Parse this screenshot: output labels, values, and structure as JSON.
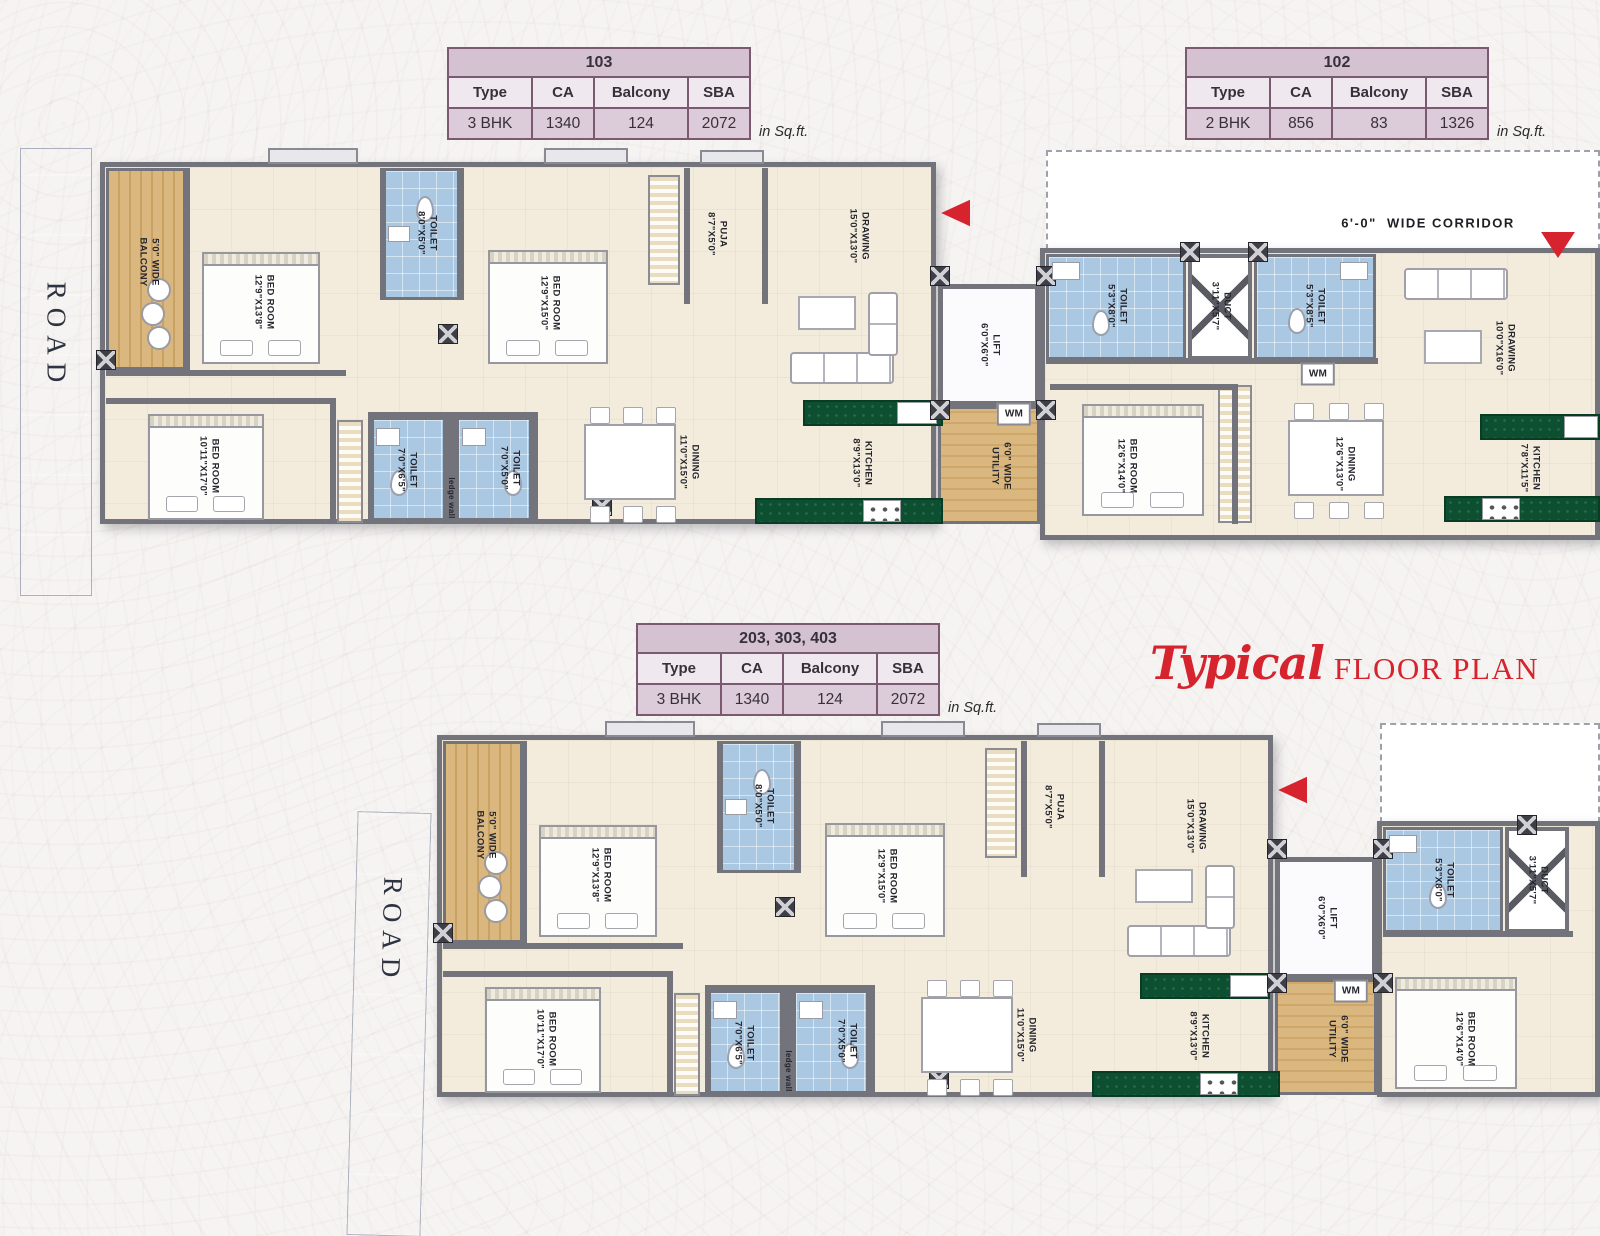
{
  "title": {
    "script": "Typical",
    "text": "FLOOR PLAN"
  },
  "roads": [
    "ROAD",
    "ROAD"
  ],
  "tables": [
    {
      "unit": "103",
      "col_headers": [
        "Type",
        "CA",
        "Balcony",
        "SBA"
      ],
      "row": [
        "3 BHK",
        "1340",
        "124",
        "2072"
      ],
      "note": "in Sq.ft."
    },
    {
      "unit": "102",
      "col_headers": [
        "Type",
        "CA",
        "Balcony",
        "SBA"
      ],
      "row": [
        "2 BHK",
        "856",
        "83",
        "1326"
      ],
      "note": "in Sq.ft."
    },
    {
      "unit": "203, 303, 403",
      "col_headers": [
        "Type",
        "CA",
        "Balcony",
        "SBA"
      ],
      "row": [
        "3 BHK",
        "1340",
        "124",
        "2072"
      ],
      "note": "in Sq.ft."
    }
  ],
  "colors": {
    "accent_red": "#d7232e",
    "table_border": "#7b5a71",
    "table_header_bg": "#d5c2d1",
    "table_subheader_bg": "#efe8ee",
    "table_value_bg": "#dccbd8",
    "road": "#c7cdd9",
    "toilet_blue": "#abc8e3",
    "wood": "#d7b27c",
    "counter_green": "#0c4f31",
    "floor_cream": "#f3ecdc",
    "wall_gray": "#73737c"
  },
  "plans": [
    {
      "labels": [
        {
          "text": "5'0\" WIDE\nBALCONY",
          "x": 148,
          "y": 262,
          "r": 90
        },
        {
          "text": "BED ROOM\n12'9\"X13'8\"",
          "x": 263,
          "y": 302,
          "r": 90
        },
        {
          "text": "TOILET\n8'0\"X5'0\"",
          "x": 426,
          "y": 233,
          "r": 90
        },
        {
          "text": "BED ROOM\n12'9\"X15'0\"",
          "x": 549,
          "y": 303,
          "r": 90
        },
        {
          "text": "PUJA\n8'7\"X5'0\"",
          "x": 716,
          "y": 234,
          "r": 90
        },
        {
          "text": "DRAWING\n15'0\"X13'0\"",
          "x": 858,
          "y": 236,
          "r": 90
        },
        {
          "text": "LIFT\n6'0\"X6'0\"",
          "x": 989,
          "y": 345,
          "r": 90
        },
        {
          "text": "BED ROOM\n10'11\"X17'0\"",
          "x": 208,
          "y": 466,
          "r": 90
        },
        {
          "text": "TOILET\n7'0\"X6'5\"",
          "x": 406,
          "y": 470,
          "r": 90
        },
        {
          "text": "ledge wall",
          "x": 451,
          "y": 498,
          "r": 90,
          "cls": "small"
        },
        {
          "text": "TOILET\n7'0\"X5'0\"",
          "x": 509,
          "y": 468,
          "r": 90
        },
        {
          "text": "DINING\n11'0\"X15'0\"",
          "x": 688,
          "y": 462,
          "r": 90
        },
        {
          "text": "KITCHEN\n8'9\"X13'0\"",
          "x": 861,
          "y": 463,
          "r": 90
        },
        {
          "text": "6'0\" WIDE\nUTILITY",
          "x": 1000,
          "y": 466,
          "r": 90
        },
        {
          "text": "WM",
          "x": 1014,
          "y": 414,
          "r": 0,
          "cls": "boxed"
        },
        {
          "text": "TOILET\n5'3\"X8'0\"",
          "x": 1116,
          "y": 306,
          "r": 90
        },
        {
          "text": "DUCT\n3'11\"X5'7\"",
          "x": 1220,
          "y": 306,
          "r": 90
        },
        {
          "text": "TOILET\n5'3\"X8'5\"",
          "x": 1314,
          "y": 306,
          "r": 90
        },
        {
          "text": "WM",
          "x": 1318,
          "y": 374,
          "r": 0,
          "cls": "boxed"
        },
        {
          "text": "DRAWING\n10'0\"X16'0\"",
          "x": 1504,
          "y": 348,
          "r": 90
        },
        {
          "text": "BED ROOM\n12'6\"X14'0\"",
          "x": 1126,
          "y": 466,
          "r": 90
        },
        {
          "text": "DINING\n12'6\"X13'0\"",
          "x": 1344,
          "y": 464,
          "r": 90
        },
        {
          "text": "KITCHEN\n7'8\"X11'5\"",
          "x": 1529,
          "y": 468,
          "r": 90
        },
        {
          "text": "6'-0\"  WIDE CORRIDOR",
          "x": 1428,
          "y": 224,
          "r": 0,
          "cls": "corridor"
        }
      ]
    },
    {
      "labels": [
        {
          "text": "5'0\" WIDE\nBALCONY",
          "x": 485,
          "y": 835,
          "r": 90
        },
        {
          "text": "BED ROOM\n12'9\"X13'8\"",
          "x": 600,
          "y": 875,
          "r": 90
        },
        {
          "text": "TOILET\n8'0\"X5'0\"",
          "x": 763,
          "y": 806,
          "r": 90
        },
        {
          "text": "BED ROOM\n12'9\"X15'0\"",
          "x": 886,
          "y": 876,
          "r": 90
        },
        {
          "text": "PUJA\n8'7\"X5'0\"",
          "x": 1053,
          "y": 807,
          "r": 90
        },
        {
          "text": "DRAWING\n15'0\"X13'0\"",
          "x": 1195,
          "y": 826,
          "r": 90
        },
        {
          "text": "BED ROOM\n10'11\"X17'0\"",
          "x": 545,
          "y": 1039,
          "r": 90
        },
        {
          "text": "TOILET\n7'0\"X6'5\"",
          "x": 743,
          "y": 1043,
          "r": 90
        },
        {
          "text": "ledge wall",
          "x": 788,
          "y": 1071,
          "r": 90,
          "cls": "small"
        },
        {
          "text": "TOILET\n7'0\"X5'0\"",
          "x": 846,
          "y": 1041,
          "r": 90
        },
        {
          "text": "DINING\n11'0\"X15'0\"",
          "x": 1025,
          "y": 1035,
          "r": 90
        },
        {
          "text": "KITCHEN\n8'9\"X13'0\"",
          "x": 1198,
          "y": 1036,
          "r": 90
        },
        {
          "text": "6'0\" WIDE\nUTILITY",
          "x": 1337,
          "y": 1039,
          "r": 90
        },
        {
          "text": "WM",
          "x": 1351,
          "y": 991,
          "r": 0,
          "cls": "boxed"
        },
        {
          "text": "LIFT\n6'0\"X6'0\"",
          "x": 1326,
          "y": 918,
          "r": 90
        },
        {
          "text": "TOILET\n5'3\"X8'0\"",
          "x": 1443,
          "y": 880,
          "r": 90
        },
        {
          "text": "DUCT\n3'11\"X5'7\"",
          "x": 1537,
          "y": 880,
          "r": 90
        },
        {
          "text": "BED ROOM\n12'6\"X14'0\"",
          "x": 1464,
          "y": 1039,
          "r": 90
        }
      ]
    }
  ]
}
